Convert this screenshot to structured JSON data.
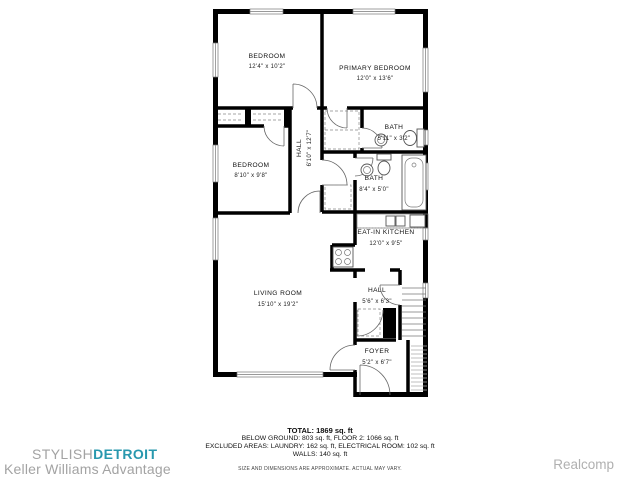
{
  "plan": {
    "rooms": [
      {
        "name": "BEDROOM",
        "dims": "12'4\" x 10'2\""
      },
      {
        "name": "PRIMARY BEDROOM",
        "dims": "12'0\" x 13'6\""
      },
      {
        "name": "BEDROOM",
        "dims": "8'10\" x 9'8\""
      },
      {
        "name": "HALL",
        "dims": "6'10\" x 12'7\""
      },
      {
        "name": "BATH",
        "dims": "5'11\" x 3'2\""
      },
      {
        "name": "BATH",
        "dims": "8'4\" x 5'0\""
      },
      {
        "name": "EAT-IN KITCHEN",
        "dims": "12'0\" x 9'5\""
      },
      {
        "name": "HALL",
        "dims": "5'6\" x 6'3\""
      },
      {
        "name": "LIVING ROOM",
        "dims": "15'10\" x 19'2\""
      },
      {
        "name": "FOYER",
        "dims": "5'2\" x 6'7\""
      }
    ]
  },
  "summary": {
    "total": "TOTAL: 1869 sq. ft",
    "line1": "BELOW GROUND: 803 sq. ft, FLOOR 2: 1066 sq. ft",
    "line2": "EXCLUDED AREAS: LAUNDRY: 162 sq. ft, ELECTRICAL ROOM: 102 sq. ft",
    "line3": "WALLS: 140 sq. ft",
    "disclaimer": "SIZE AND DIMENSIONS ARE APPROXIMATE. ACTUAL MAY VARY."
  },
  "footer": {
    "brand_light": "STYLISH",
    "brand_bold": "DETROIT",
    "brand_sub": "Keller Williams Advantage",
    "watermark": "Realcomp"
  },
  "colors": {
    "wall": "#000000",
    "brand_teal": "#2898ae",
    "muted_gray": "#a3a3a3"
  }
}
